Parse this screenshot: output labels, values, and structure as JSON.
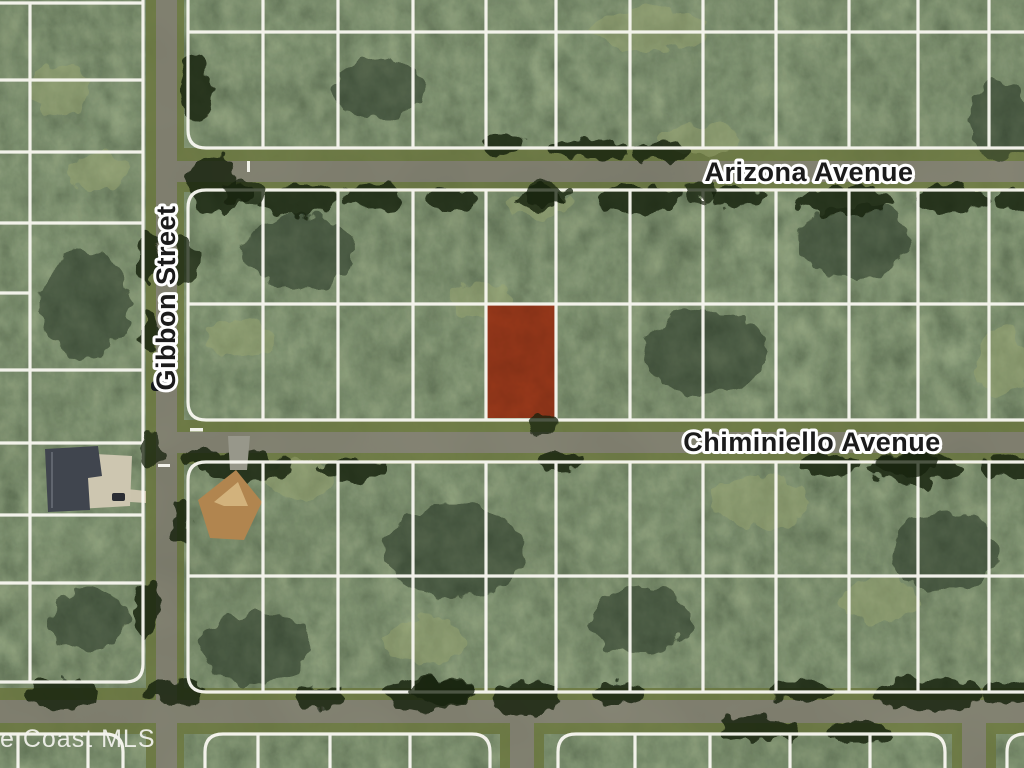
{
  "map": {
    "kind": "satellite-parcel-map",
    "streets": [
      {
        "name": "Arizona Avenue",
        "orientation": "horizontal"
      },
      {
        "name": "Gibbon Street",
        "orientation": "vertical"
      },
      {
        "name": "Chiminiello Avenue",
        "orientation": "horizontal"
      }
    ],
    "watermark": "e Coast MLS",
    "highlighted_parcel": {
      "fill": "#9c3a1b",
      "position": "south side of Chiminiello Avenue, east of Gibbon Street"
    },
    "colors": {
      "label_text": "#1b1b1b",
      "label_halo": "#ffffff",
      "parcel_line": "#f8f7f0",
      "road_pavement": "#8d8b7c",
      "road_shoulder": "#778349",
      "watermark_text": "#f4f4ef",
      "tree_dark": "#22301c",
      "tree_light": "#93a26c",
      "driveway": "#cbc4ad",
      "roof_west_house": "#40454e",
      "roof_east_house": "#b1854f"
    }
  }
}
